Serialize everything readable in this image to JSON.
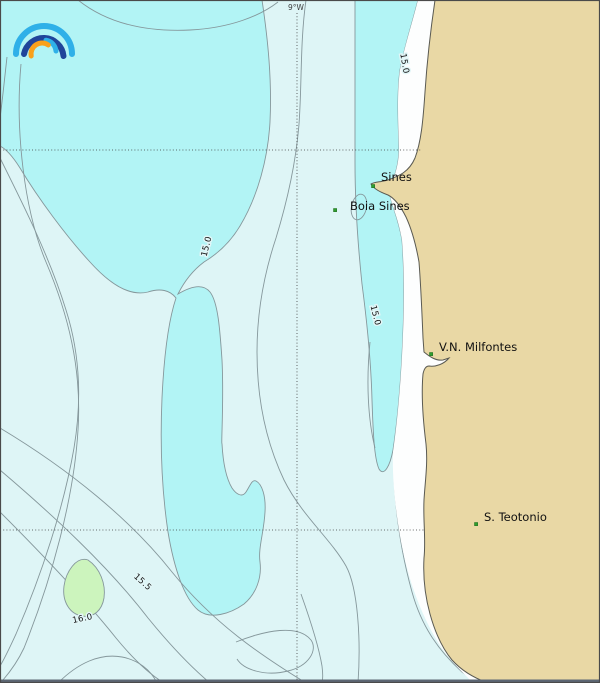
{
  "map": {
    "graticule": {
      "meridian_label": "9°W"
    },
    "places": [
      {
        "name": "Sines"
      },
      {
        "name": "Boia Sines"
      },
      {
        "name": "V.N. Milfontes"
      },
      {
        "name": "S. Teotonio"
      }
    ],
    "isotherm_labels": [
      {
        "text": "15.0"
      },
      {
        "text": "15.0"
      },
      {
        "text": "15.0"
      },
      {
        "text": "15.5"
      },
      {
        "text": "16.0"
      }
    ],
    "colors": {
      "sea_base": "#def5f6",
      "sea_cool": "#b2f4f5",
      "sea_warm": "#ccf4bd",
      "land": "#e9d8a5",
      "shore": "#fdfefe",
      "contour": "#85979b",
      "coastline": "#5a5a52",
      "graticule": "#3c3c3c",
      "marker": "#2f9e2f",
      "marker_border": "#1d6b1d",
      "label": "#111111",
      "frame": "#4a4a4a",
      "frame_bottom": "#5c6673"
    },
    "logo": {
      "colors": {
        "outer": "#2fb0e8",
        "mid": "#20459a",
        "inner": "#2fb0e8",
        "orange": "#f9a11b"
      }
    }
  }
}
